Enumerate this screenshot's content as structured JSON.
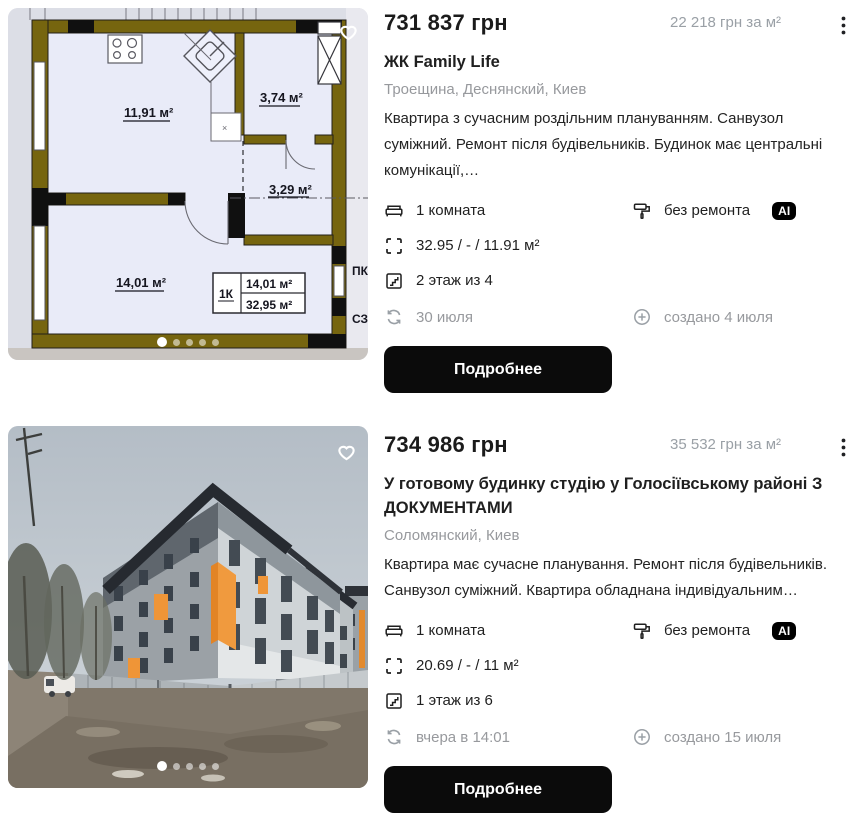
{
  "colors": {
    "button_bg": "#0b0b0b",
    "ai_badge_bg": "#000000",
    "text_secondary": "#97999d",
    "plan_wall": "#76650f",
    "plan_room": "#e9ebf8",
    "photo_orange": "#ef9537"
  },
  "carousel": {
    "count": 5,
    "active": 0
  },
  "listings": [
    {
      "price": "731 837 грн",
      "price_per_m2": "22 218 грн за м²",
      "title": "ЖК Family Life",
      "location": "Троещина, Деснянский, Киев",
      "description": "Квартира з сучасним роздільним плануванням. Санвузол суміжний. Ремонт після будівельників. Будинок має центральні комунікації,…",
      "attributes": {
        "rooms": "1 комната",
        "renovation": "без ремонта",
        "renovation_badge": "AI",
        "area": "32.95 / - / 11.91 м²",
        "floor": "2 этаж из 4"
      },
      "updated": "30 июля",
      "created": "создано 4 июля",
      "details_button": "Подробнее",
      "plan_labels": {
        "kitchen": "11,91 м²",
        "room_top": "3,74 м²",
        "hall": "3,29 м²",
        "room_bottom": "14,01 м²",
        "table_type": "1К",
        "table_room": "14,01 м²",
        "table_total": "32,95 м²",
        "label_pk": "ПК",
        "label_sz": "СЗ"
      }
    },
    {
      "price": "734 986 грн",
      "price_per_m2": "35 532 грн за м²",
      "title": "У готовому будинку студію у Голосіївському районі З ДОКУМЕНТАМИ",
      "location": "Соломянский, Киев",
      "description": "Квартира має сучасне планування. Ремонт після будівельників. Санвузол суміжний. Квартира обладнана індивідуальним…",
      "attributes": {
        "rooms": "1 комната",
        "renovation": "без ремонта",
        "renovation_badge": "AI",
        "area": "20.69 / - / 11 м²",
        "floor": "1 этаж из 6"
      },
      "updated": "вчера в 14:01",
      "created": "создано 15 июля",
      "details_button": "Подробнее"
    }
  ]
}
